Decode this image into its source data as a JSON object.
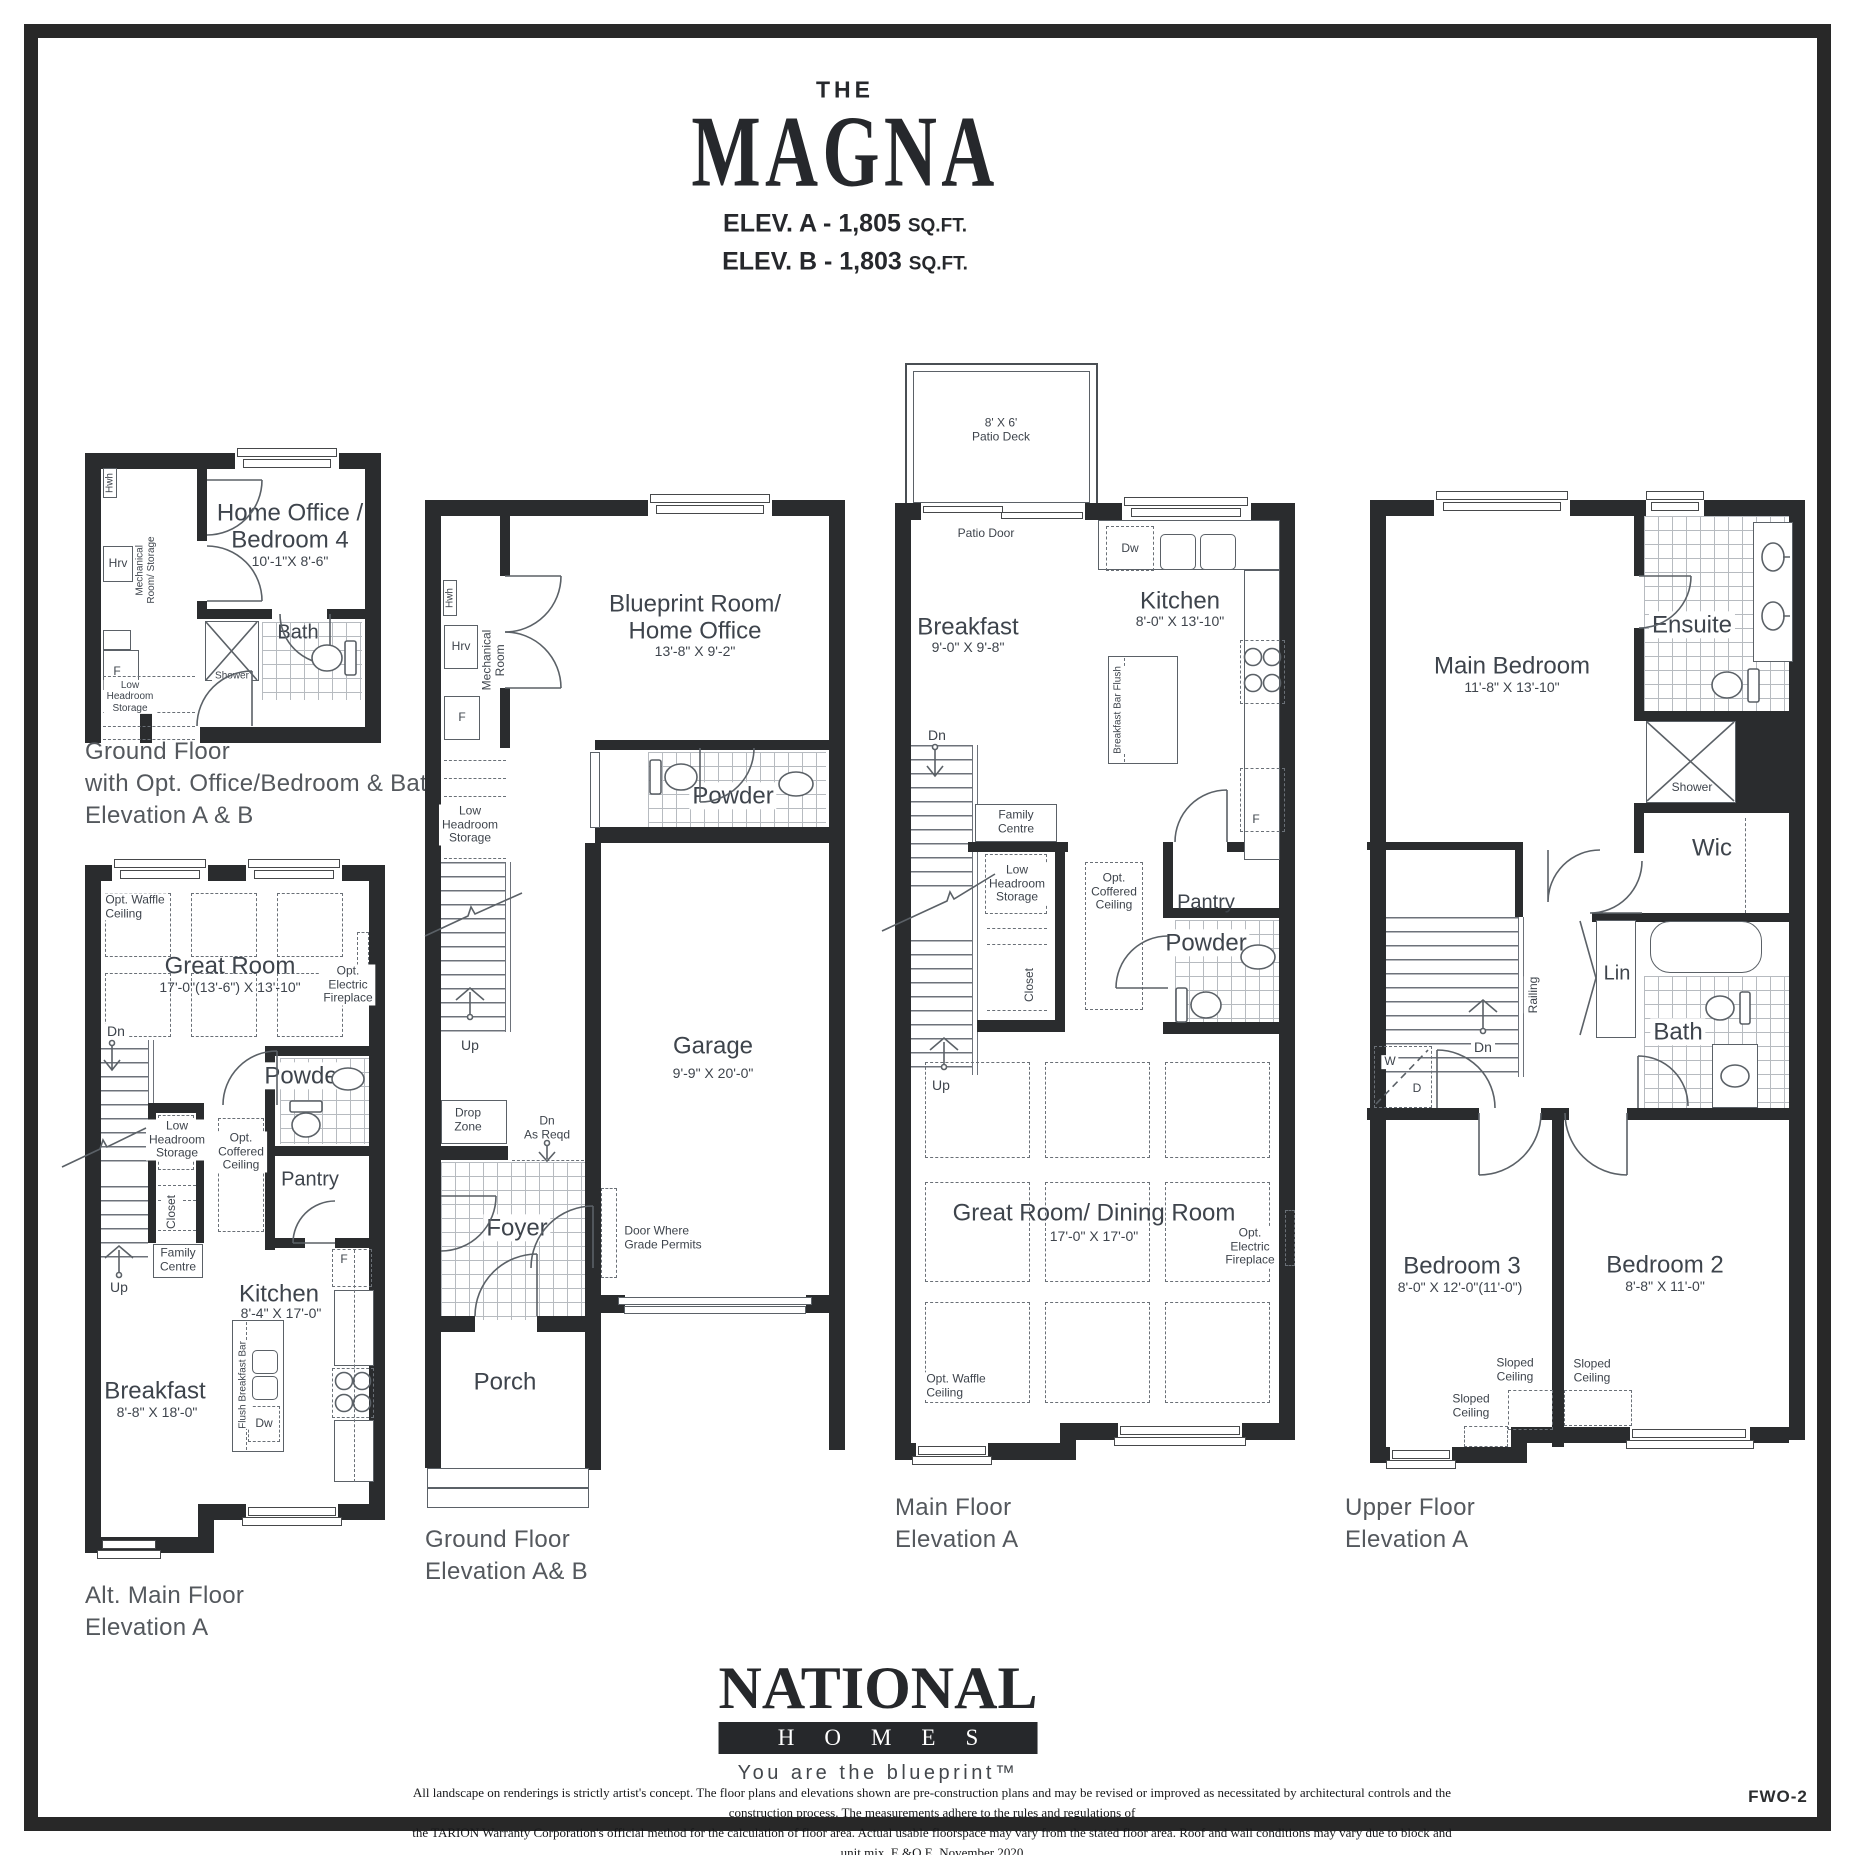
{
  "header": {
    "the": "THE",
    "name": "MAGNA",
    "elev_a": {
      "main": "ELEV. A - 1,805 ",
      "unit": "SQ.FT."
    },
    "elev_b": {
      "main": "ELEV. B - 1,803 ",
      "unit": "SQ.FT."
    }
  },
  "captions": {
    "plan_a": "Ground Floor\nwith Opt. Office/Bedroom & Bath\nElevation A & B",
    "plan_b": "Alt. Main Floor\nElevation A",
    "plan_c": "Ground Floor\nElevation A& B",
    "plan_d": "Main Floor\nElevation A",
    "plan_e": "Upper Floor\nElevation A"
  },
  "rooms": {
    "home_office": {
      "name": "Home Office /\nBedroom 4",
      "dims": "10'-1\"X 8'-6\""
    },
    "bath_a": {
      "name": "Bath"
    },
    "blueprint": {
      "name": "Blueprint Room/\nHome Office",
      "dims": "13'-8\" X 9'-2\""
    },
    "powder": {
      "name": "Powder"
    },
    "garage": {
      "name": "Garage",
      "dims": "9'-9\"  X 20'-0\""
    },
    "foyer": {
      "name": "Foyer"
    },
    "porch": {
      "name": "Porch"
    },
    "great_room_b": {
      "name": "Great Room",
      "dims": "17'-0\"(13'-6\") X 13'-10\""
    },
    "kitchen_b": {
      "name": "Kitchen",
      "dims": "8'-4\" X 17'-0\""
    },
    "breakfast_b": {
      "name": "Breakfast",
      "dims": "8'-8\" X 18'-0\""
    },
    "kitchen_d": {
      "name": "Kitchen",
      "dims": "8'-0\" X 13'-10\""
    },
    "breakfast_d": {
      "name": "Breakfast",
      "dims": "9'-0\" X 9'-8\""
    },
    "great_dining": {
      "name": "Great Room/ Dining Room",
      "dims": "17'-0\" X 17'-0\""
    },
    "main_bedroom": {
      "name": "Main Bedroom",
      "dims": "11'-8\" X 13'-10\""
    },
    "bedroom3": {
      "name": "Bedroom 3",
      "dims": "8'-0\" X 12'-0\"(11'-0\")"
    },
    "bedroom2": {
      "name": "Bedroom 2",
      "dims": "8'-8\" X 11'-0\""
    },
    "ensuite": {
      "name": "Ensuite"
    },
    "bath_e": {
      "name": "Bath"
    },
    "wic": {
      "name": "Wic"
    },
    "lin": {
      "name": "Lin"
    }
  },
  "labels": {
    "hwh": "Hwh",
    "hrv": "Hrv",
    "f": "F",
    "dw": "Dw",
    "w": "W",
    "d": "D",
    "up": "Up",
    "dn": "Dn",
    "shower": "Shower",
    "mech_storage": "Mechanical\nRoom/ Storage",
    "mech_room": "Mechanical\nRoom",
    "low_headroom": "Low\nHeadroom\nStorage",
    "family_centre": "Family\nCentre",
    "closet": "Closet",
    "pantry": "Pantry",
    "coffered": "Opt.\nCoffered\nCeiling",
    "waffle": "Opt. Waffle\nCeiling",
    "fireplace": "Opt.\nElectric\nFireplace",
    "drop_zone": "Drop\nZone",
    "dn_as_reqd": "Dn\nAs Reqd",
    "door_grade": "Door Where\nGrade Permits",
    "patio_deck": "8' X 6'\nPatio Deck",
    "patio_door": "Patio Door",
    "bbf": "Breakfast Bar Flush",
    "flush_bar": "Flush Breakfast Bar",
    "railing": "Railing",
    "sloped": "Sloped\nCeiling"
  },
  "logo": {
    "name": "NATIONAL",
    "homes": "HOMES",
    "tagline": "You are the blueprint™"
  },
  "footer": {
    "disclaimer1": "All landscape on renderings is strictly artist's concept. The floor plans and elevations shown are pre-construction plans and may be revised or improved as necessitated by architectural controls and the construction process. The measurements adhere to the rules and regulations of",
    "disclaimer2": "the TARION Warranty Corporation's official method for the calculation of floor area. Actual usable floorspace may vary from the stated floor area. Roof and wall conditions may vary due to block and unit mix.  E.&O.E. November 2020",
    "sheet": "FWO-2"
  }
}
